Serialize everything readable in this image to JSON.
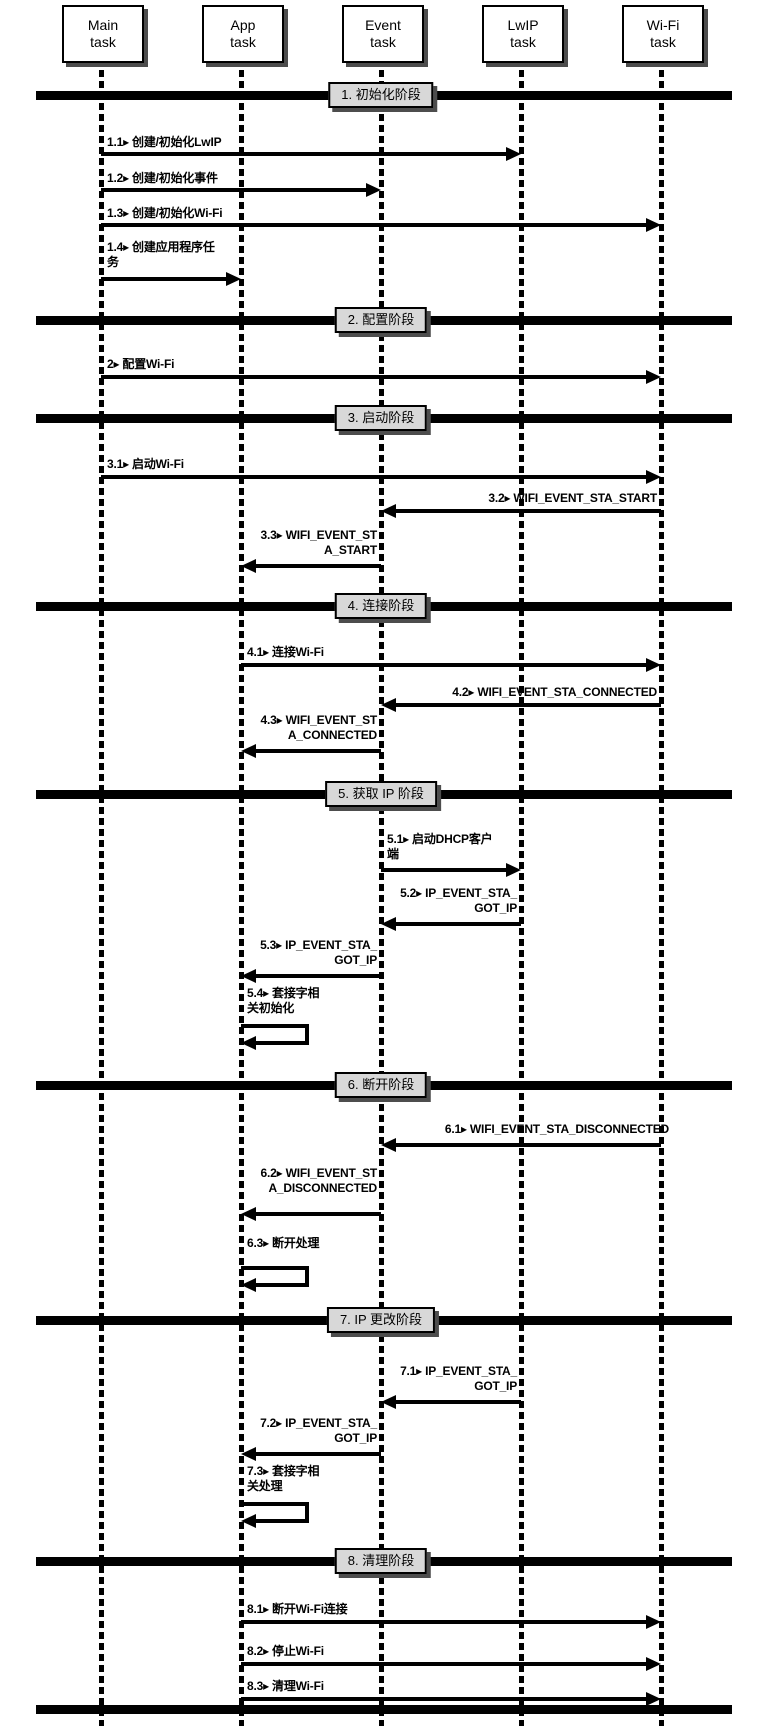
{
  "diagram": {
    "type": "sequence",
    "canvas": {
      "width": 768,
      "height": 1726
    },
    "colors": {
      "ink": "#000000",
      "paper": "#ffffff",
      "phase_box_bg": "#d8d8d8",
      "shadow": "#4d4d4d"
    },
    "task_box": {
      "width": 78,
      "height": 54,
      "top": 5
    },
    "lifeline": {
      "top": 59,
      "bottom": 1726,
      "width": 5
    },
    "phase_bar": {
      "x1": 36,
      "x2": 732,
      "thickness": 9,
      "label_center_x": 381
    },
    "end_bar_y": 1710,
    "tasks": [
      {
        "id": "main",
        "label_lines": [
          "Main",
          "task"
        ],
        "x": 101
      },
      {
        "id": "app",
        "label_lines": [
          "App",
          "task"
        ],
        "x": 241
      },
      {
        "id": "event",
        "label_lines": [
          "Event",
          "task"
        ],
        "x": 381
      },
      {
        "id": "lwip",
        "label_lines": [
          "LwIP",
          "task"
        ],
        "x": 521
      },
      {
        "id": "wifi",
        "label_lines": [
          "Wi-Fi",
          "task"
        ],
        "x": 661
      }
    ],
    "phases": [
      {
        "num": 1,
        "label": "1. 初始化阶段",
        "y": 96
      },
      {
        "num": 2,
        "label": "2. 配置阶段",
        "y": 321
      },
      {
        "num": 3,
        "label": "3. 启动阶段",
        "y": 419
      },
      {
        "num": 4,
        "label": "4. 连接阶段",
        "y": 607
      },
      {
        "num": 5,
        "label": "5. 获取 IP 阶段",
        "y": 795
      },
      {
        "num": 6,
        "label": "6. 断开阶段",
        "y": 1086
      },
      {
        "num": 7,
        "label": "7. IP 更改阶段",
        "y": 1321
      },
      {
        "num": 8,
        "label": "8. 清理阶段",
        "y": 1562
      }
    ],
    "messages": [
      {
        "id": "1.1",
        "lines": [
          "1.1▸ 创建/初始化LwIP"
        ],
        "from": "main",
        "to": "lwip",
        "arrow_y": 152,
        "label_y": 135,
        "align": "left"
      },
      {
        "id": "1.2",
        "lines": [
          "1.2▸ 创建/初始化事件"
        ],
        "from": "main",
        "to": "event",
        "arrow_y": 188,
        "label_y": 171,
        "align": "left"
      },
      {
        "id": "1.3",
        "lines": [
          "1.3▸ 创建/初始化Wi-Fi"
        ],
        "from": "main",
        "to": "wifi",
        "arrow_y": 223,
        "label_y": 206,
        "align": "left"
      },
      {
        "id": "1.4",
        "lines": [
          "1.4▸ 创建应用程序任",
          "务"
        ],
        "from": "main",
        "to": "app",
        "arrow_y": 277,
        "label_y": 240,
        "align": "left"
      },
      {
        "id": "2",
        "lines": [
          "2▸ 配置Wi-Fi"
        ],
        "from": "main",
        "to": "wifi",
        "arrow_y": 375,
        "label_y": 357,
        "align": "left"
      },
      {
        "id": "3.1",
        "lines": [
          "3.1▸ 启动Wi-Fi"
        ],
        "from": "main",
        "to": "wifi",
        "arrow_y": 475,
        "label_y": 457,
        "align": "left"
      },
      {
        "id": "3.2",
        "lines": [
          "3.2▸ WIFI_EVENT_STA_START"
        ],
        "from": "wifi",
        "to": "event",
        "arrow_y": 509,
        "label_y": 491,
        "align": "right"
      },
      {
        "id": "3.3",
        "lines": [
          "3.3▸ WIFI_EVENT_ST",
          "A_START"
        ],
        "from": "event",
        "to": "app",
        "arrow_y": 564,
        "label_y": 528,
        "align": "right"
      },
      {
        "id": "4.1",
        "lines": [
          "4.1▸ 连接Wi-Fi"
        ],
        "from": "app",
        "to": "wifi",
        "arrow_y": 663,
        "label_y": 645,
        "align": "left"
      },
      {
        "id": "4.2",
        "lines": [
          "4.2▸ WIFI_EVENT_STA_CONNECTED"
        ],
        "from": "wifi",
        "to": "event",
        "arrow_y": 703,
        "label_y": 685,
        "align": "right"
      },
      {
        "id": "4.3",
        "lines": [
          "4.3▸ WIFI_EVENT_ST",
          "A_CONNECTED"
        ],
        "from": "event",
        "to": "app",
        "arrow_y": 749,
        "label_y": 713,
        "align": "right"
      },
      {
        "id": "5.1",
        "lines": [
          "5.1▸ 启动DHCP客户",
          "端"
        ],
        "from": "event",
        "to": "lwip",
        "arrow_y": 868,
        "label_y": 832,
        "align": "left"
      },
      {
        "id": "5.2",
        "lines": [
          "5.2▸ IP_EVENT_STA_",
          "GOT_IP"
        ],
        "from": "lwip",
        "to": "event",
        "arrow_y": 922,
        "label_y": 886,
        "align": "right"
      },
      {
        "id": "5.3",
        "lines": [
          "5.3▸ IP_EVENT_STA_",
          "GOT_IP"
        ],
        "from": "event",
        "to": "app",
        "arrow_y": 974,
        "label_y": 938,
        "align": "right"
      },
      {
        "id": "5.4",
        "lines": [
          "5.4▸ 套接字相",
          "关初始化"
        ],
        "type": "self",
        "on": "app",
        "loop_y": 1024,
        "label_y": 986
      },
      {
        "id": "6.1",
        "lines": [
          "6.1▸ WIFI_EVENT_STA_DISCONNECTED"
        ],
        "from": "wifi",
        "to": "event",
        "arrow_y": 1143,
        "label_y": 1122,
        "align": "right",
        "label_overhang": 8
      },
      {
        "id": "6.2",
        "lines": [
          "6.2▸ WIFI_EVENT_ST",
          "A_DISCONNECTED"
        ],
        "from": "event",
        "to": "app",
        "arrow_y": 1212,
        "label_y": 1166,
        "align": "right"
      },
      {
        "id": "6.3",
        "lines": [
          "6.3▸ 断开处理"
        ],
        "type": "self",
        "on": "app",
        "loop_y": 1266,
        "label_y": 1236
      },
      {
        "id": "7.1",
        "lines": [
          "7.1▸ IP_EVENT_STA_",
          "GOT_IP"
        ],
        "from": "lwip",
        "to": "event",
        "arrow_y": 1400,
        "label_y": 1364,
        "align": "right"
      },
      {
        "id": "7.2",
        "lines": [
          "7.2▸ IP_EVENT_STA_",
          "GOT_IP"
        ],
        "from": "event",
        "to": "app",
        "arrow_y": 1452,
        "label_y": 1416,
        "align": "right"
      },
      {
        "id": "7.3",
        "lines": [
          "7.3▸ 套接字相",
          "关处理"
        ],
        "type": "self",
        "on": "app",
        "loop_y": 1502,
        "label_y": 1464
      },
      {
        "id": "8.1",
        "lines": [
          "8.1▸ 断开Wi-Fi连接"
        ],
        "from": "app",
        "to": "wifi",
        "arrow_y": 1620,
        "label_y": 1602,
        "align": "left"
      },
      {
        "id": "8.2",
        "lines": [
          "8.2▸ 停止Wi-Fi"
        ],
        "from": "app",
        "to": "wifi",
        "arrow_y": 1662,
        "label_y": 1644,
        "align": "left"
      },
      {
        "id": "8.3",
        "lines": [
          "8.3▸ 清理Wi-Fi"
        ],
        "from": "app",
        "to": "wifi",
        "arrow_y": 1697,
        "label_y": 1679,
        "align": "left"
      }
    ]
  }
}
